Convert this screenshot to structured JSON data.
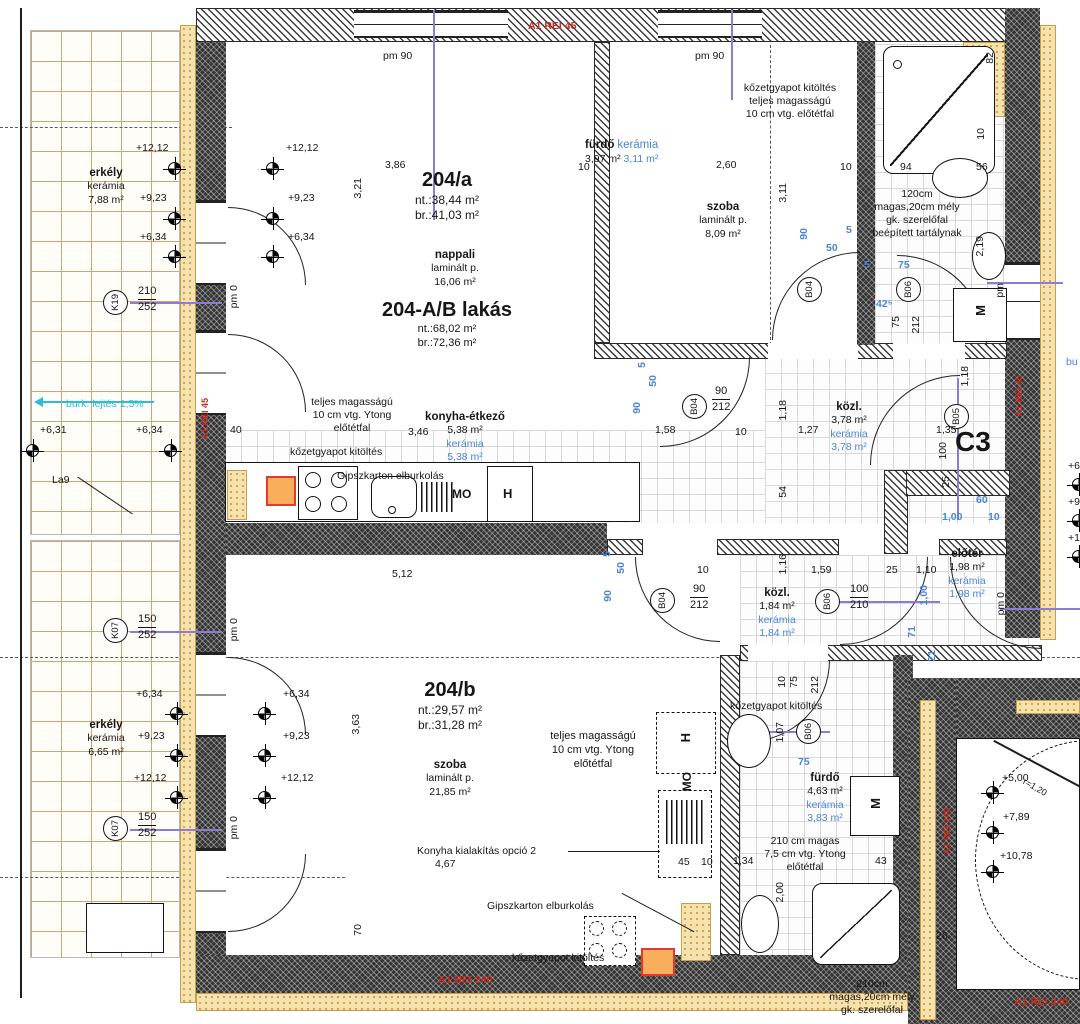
{
  "apartments": {
    "a": {
      "title": "204/a",
      "nt": "nt.:38,44 m²",
      "br": "br.:41,03 m²"
    },
    "ab": {
      "title": "204-A/B lakás",
      "nt": "nt.:68,02 m²",
      "br": "br.:72,36 m²"
    },
    "b": {
      "title": "204/b",
      "nt": "nt.:29,57 m²",
      "br": "br.:31,28 m²"
    }
  },
  "rooms": {
    "nappali": {
      "name": "nappali",
      "floor": "laminált p.",
      "area": "16,06 m²"
    },
    "szoba_a": {
      "name": "szoba",
      "floor": "laminált p.",
      "area": "8,09 m²"
    },
    "konyha": {
      "name": "konyha-étkező",
      "area": "5,38 m²",
      "ker": "kerámia",
      "ker_area": "5,38 m²"
    },
    "furdo_a": {
      "name": "fürdő",
      "area": "3,97 m²",
      "ker": "kerámia",
      "ker_area": "3,11 m²"
    },
    "kozl_a": {
      "name": "közl.",
      "area": "3,78 m²",
      "ker": "kerámia",
      "ker_area": "3,78 m²"
    },
    "kozl_b": {
      "name": "közl.",
      "area": "1,84 m²",
      "ker": "kerámia",
      "ker_area": "1,84 m²"
    },
    "eloter": {
      "name": "előtér",
      "area": "1,98 m²",
      "ker": "kerámia",
      "ker_area": "1,98 m²"
    },
    "szoba_b": {
      "name": "szoba",
      "floor": "laminált p.",
      "area": "21,85 m²"
    },
    "furdo_b": {
      "name": "fürdő",
      "area": "4,63 m²",
      "ker": "kerámia",
      "ker_area": "3,83 m²"
    },
    "erkely_a": {
      "name": "erkély",
      "ker": "kerámia",
      "area": "7,88 m²"
    },
    "erkely_b": {
      "name": "erkély",
      "ker": "kerámia",
      "area": "6,65 m²"
    }
  },
  "notes": {
    "rockwool": "kőzetgyapot kitöltés",
    "full_height": "teljes magasságú",
    "ytong10": "10 cm vtg. Ytong",
    "front10": "10 cm vtg. előtétfal",
    "front_wall": "előtétfal",
    "gypsum": "Gipszkarton elburkolás",
    "tank1": "120cm",
    "tank2": "magas,20cm mély",
    "tank3": "gk. szerelőfal",
    "tank4": "beépített tartálynak",
    "wall210a": "210 cm magas",
    "wall210b": "7,5 cm vtg. Ytong",
    "wall210c": "előtétfal",
    "shaft1": "210cm",
    "shaft2": "magas,20cm mély",
    "shaft3": "gk. szerelőfal",
    "kitchen_option": "Konyha kialakítás opció 2",
    "slope": "burk. lejtés 1,5%",
    "la9": "La9",
    "c3": "C3",
    "bu": "bu"
  },
  "fire": {
    "rei45": "A1 REI 45",
    "rei240": "A1 REI 240"
  },
  "levels": {
    "l1212": "+12,12",
    "l923": "+9,23",
    "l634": "+6,34",
    "l631": "+6,31",
    "l500": "+5,00",
    "l789": "+7,89",
    "l1078": "+10,78",
    "p6": "+6",
    "p9": "+9",
    "p1": "+1"
  },
  "tags": {
    "k19": "K19",
    "k07": "K07",
    "b04": "B04",
    "b05": "B05",
    "b06": "B06",
    "s210": "210",
    "s252": "252",
    "s150": "150"
  },
  "pm": {
    "pm90": "pm 90",
    "pm0": "pm 0",
    "pm": "pm"
  },
  "appliances": {
    "h": "H",
    "mo": "MO",
    "m": "M"
  },
  "dims": {
    "d386": "3,86",
    "d10": "10",
    "d260": "2,60",
    "d321": "3,21",
    "d311": "3,11",
    "d94": "94",
    "d56": "56",
    "d82": "82",
    "d219": "2,19",
    "d40": "40",
    "d346": "3,46",
    "d158": "1,58",
    "d127": "1,27",
    "d118": "1,18",
    "d135": "1,35",
    "d100": "100",
    "d25": "25",
    "d54": "54",
    "d159": "1,59",
    "d110": "1,10",
    "d116": "1,16",
    "d512": "5,12",
    "d363": "3,63",
    "d467": "4,67",
    "d45": "45",
    "d134": "1,34",
    "d43": "43",
    "d107": "1,07",
    "d200": "2,00",
    "d70": "70",
    "d26": "26",
    "d75": "75",
    "d212": "212",
    "d90": "90",
    "d210": "210",
    "dr120": "r=1,20"
  },
  "bluedims": {
    "b90": "90",
    "b50": "50",
    "b5": "5",
    "b75": "75",
    "b425": "42⁵",
    "b60": "60",
    "b100": "1,00",
    "b10": "10",
    "b71": "71",
    "b21": "21"
  }
}
